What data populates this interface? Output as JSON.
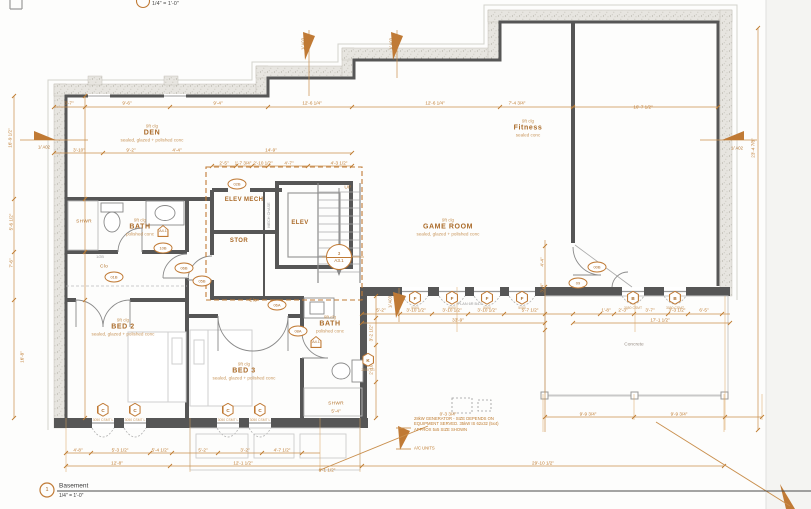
{
  "titles": {
    "top_scale": "1/4\" = 1'-0\"",
    "viewport_number": "1",
    "view_name": "Basement",
    "view_scale": "1/4\" = 1'-0\""
  },
  "colors": {
    "dim_orange": "#bf7b2f",
    "wall_gray": "#565656",
    "hatch_fill": "#e7e5e0"
  },
  "rooms": [
    {
      "name": "DEN",
      "clg": "9ft clg",
      "finish": "sealed, glazed + polished conc",
      "x": 152,
      "y": 133
    },
    {
      "name": "Fitness",
      "clg": "9ft clg",
      "finish": "sealed conc",
      "x": 528,
      "y": 128
    },
    {
      "name": "GAME ROOM",
      "clg": "9ft clg",
      "finish": "sealed, glazed + polished conc",
      "x": 448,
      "y": 227
    },
    {
      "name": "BATH",
      "clg": "9ft clg",
      "finish": "polished conc",
      "x": 140,
      "y": 227
    },
    {
      "name": "BED 2",
      "clg": "9ft clg",
      "finish": "sealed, glazed + polished conc",
      "x": 123,
      "y": 327
    },
    {
      "name": "BED 3",
      "clg": "9ft clg",
      "finish": "sealed, glazed + polished conc",
      "x": 244,
      "y": 371
    },
    {
      "name": "BATH",
      "clg": "9ft clg",
      "finish": "polished conc",
      "x": 330,
      "y": 324
    }
  ],
  "labels": [
    {
      "t": "ELEV MECH",
      "x": 244,
      "y": 200,
      "c": "rs"
    },
    {
      "t": "STOR",
      "x": 239,
      "y": 241,
      "c": "rs"
    },
    {
      "t": "ELEV",
      "x": 300,
      "y": 223,
      "c": "rs"
    },
    {
      "t": "Clo",
      "x": 104,
      "y": 267,
      "c": "lbl"
    },
    {
      "t": "Clo",
      "x": 253,
      "y": 301,
      "c": "lbl"
    },
    {
      "t": "SHWR",
      "x": 84,
      "y": 222,
      "c": "lbl"
    },
    {
      "t": "SHWR",
      "x": 336,
      "y": 404,
      "c": "lbl"
    },
    {
      "t": "UP",
      "x": 348,
      "y": 188,
      "c": "lbl"
    },
    {
      "t": "Concrete",
      "x": 634,
      "y": 345,
      "c": "lblg"
    },
    {
      "t": "MECH CHASE",
      "x": 269,
      "y": 215,
      "c": "tiny",
      "r": -90
    },
    {
      "t": "1/2B",
      "x": 100,
      "y": 257,
      "c": "tiny"
    },
    {
      "t": "PLAN 6R B4.0",
      "x": 470,
      "y": 304,
      "c": "tiny"
    }
  ],
  "dims": [
    {
      "t": "3'-7\"",
      "x": 69,
      "y": 103
    },
    {
      "t": "9'-6\"",
      "x": 127,
      "y": 103
    },
    {
      "t": "9'-4\"",
      "x": 218,
      "y": 103
    },
    {
      "t": "12'-6 1/4\"",
      "x": 312,
      "y": 103
    },
    {
      "t": "12'-6 1/4\"",
      "x": 435,
      "y": 103
    },
    {
      "t": "7'-4 3/4\"",
      "x": 517,
      "y": 103
    },
    {
      "t": "16'-7 1/2\"",
      "x": 643,
      "y": 107
    },
    {
      "t": "3'-10\"",
      "x": 79,
      "y": 150
    },
    {
      "t": "9'-2\"",
      "x": 131,
      "y": 150
    },
    {
      "t": "4'-4\"",
      "x": 177,
      "y": 150
    },
    {
      "t": "14'-9\"",
      "x": 271,
      "y": 150
    },
    {
      "t": "2'-5\"",
      "x": 224,
      "y": 163
    },
    {
      "t": "1'-7 3/4\"",
      "x": 243,
      "y": 163
    },
    {
      "t": "2'-10 1/2\"",
      "x": 263,
      "y": 163
    },
    {
      "t": "4'-7\"",
      "x": 289,
      "y": 163
    },
    {
      "t": "4'-3 1/2\"",
      "x": 339,
      "y": 163
    },
    {
      "t": "16'-9 1/2\"",
      "x": 10,
      "y": 138,
      "r": -90
    },
    {
      "t": "5'-6 1/2\"",
      "x": 11,
      "y": 222,
      "r": -90
    },
    {
      "t": "7'-6\"",
      "x": 11,
      "y": 263,
      "r": -90
    },
    {
      "t": "16'-8\"",
      "x": 22,
      "y": 357,
      "r": -90
    },
    {
      "t": "23'-4 7/8\"",
      "x": 753,
      "y": 148,
      "r": -90
    },
    {
      "t": "4'-4\"",
      "x": 542,
      "y": 262,
      "r": -90
    },
    {
      "t": "3'-4\"",
      "x": 542,
      "y": 288,
      "r": -90
    },
    {
      "t": "3'-2 1/2\"",
      "x": 371,
      "y": 333,
      "r": -90
    },
    {
      "t": "2'-10 1/2\"",
      "x": 371,
      "y": 365,
      "r": -90
    },
    {
      "t": "5'-2\"",
      "x": 381,
      "y": 310
    },
    {
      "t": "3'-10 1/2\"",
      "x": 416,
      "y": 310
    },
    {
      "t": "3'-10 1/2\"",
      "x": 452,
      "y": 310
    },
    {
      "t": "3'-10 1/2\"",
      "x": 487,
      "y": 310
    },
    {
      "t": "5'-7 1/2\"",
      "x": 530,
      "y": 310
    },
    {
      "t": "1'-8\"",
      "x": 606,
      "y": 310
    },
    {
      "t": "2'-3\"",
      "x": 623,
      "y": 310
    },
    {
      "t": "3'-7\"",
      "x": 650,
      "y": 310
    },
    {
      "t": "3'-3 1/2\"",
      "x": 677,
      "y": 310
    },
    {
      "t": "6'-5\"",
      "x": 704,
      "y": 310
    },
    {
      "t": "33'-9\"",
      "x": 458,
      "y": 320
    },
    {
      "t": "17'-1 1/2\"",
      "x": 660,
      "y": 320
    },
    {
      "t": "4'-8\"",
      "x": 78,
      "y": 450
    },
    {
      "t": "5'-3 1/2\"",
      "x": 120,
      "y": 450
    },
    {
      "t": "5'-4 1/2\"",
      "x": 160,
      "y": 450
    },
    {
      "t": "5'-2\"",
      "x": 203,
      "y": 450
    },
    {
      "t": "3'-2\"",
      "x": 245,
      "y": 450
    },
    {
      "t": "4'-7 1/2\"",
      "x": 282,
      "y": 450
    },
    {
      "t": "12'-8\"",
      "x": 117,
      "y": 463
    },
    {
      "t": "12'-1 1/2\"",
      "x": 243,
      "y": 463
    },
    {
      "t": "6'-1 1/2\"",
      "x": 327,
      "y": 470
    },
    {
      "t": "29'-10 1/2\"",
      "x": 543,
      "y": 463
    },
    {
      "t": "0'-3 3/4\"",
      "x": 448,
      "y": 414
    },
    {
      "t": "9'-9 3/4\"",
      "x": 588,
      "y": 414
    },
    {
      "t": "9'-9 3/4\"",
      "x": 679,
      "y": 414
    },
    {
      "t": "5'-4\"",
      "x": 336,
      "y": 411
    }
  ],
  "window_tags": [
    {
      "l": "C",
      "s": "3050 CSMT L",
      "x": 103,
      "y": 408
    },
    {
      "l": "C",
      "s": "3050 CSMT L",
      "x": 135,
      "y": 408
    },
    {
      "l": "C",
      "s": "3050 CSMT L",
      "x": 228,
      "y": 408
    },
    {
      "l": "C",
      "s": "3050 CSMT L",
      "x": 260,
      "y": 408
    },
    {
      "l": "F",
      "s": "5050",
      "x": 415,
      "y": 296
    },
    {
      "l": "F",
      "s": "5050",
      "x": 452,
      "y": 296
    },
    {
      "l": "F",
      "s": "5050",
      "x": 487,
      "y": 296
    },
    {
      "l": "F",
      "s": "5050",
      "x": 522,
      "y": 296
    },
    {
      "l": "B",
      "s": "3050 CSMT",
      "x": 633,
      "y": 296
    },
    {
      "l": "B",
      "s": "3050 CSMT",
      "x": 675,
      "y": 296
    },
    {
      "l": "K",
      "s": "2000 FG",
      "x": 368,
      "y": 358
    }
  ],
  "door_tags": [
    {
      "l": "10B",
      "x": 163,
      "y": 248
    },
    {
      "l": "01B",
      "x": 114,
      "y": 277
    },
    {
      "l": "06B",
      "x": 184,
      "y": 268
    },
    {
      "l": "05B",
      "x": 202,
      "y": 281
    },
    {
      "l": "02B",
      "x": 237,
      "y": 184
    },
    {
      "l": "06A",
      "x": 277,
      "y": 305
    },
    {
      "l": "08A",
      "x": 298,
      "y": 331
    },
    {
      "l": "00B",
      "x": 597,
      "y": 267
    },
    {
      "l": "09",
      "x": 578,
      "y": 283
    }
  ],
  "pent_tags": [
    {
      "l": "A4.1",
      "x": 163,
      "y": 231
    },
    {
      "l": "A4.1",
      "x": 316,
      "y": 342
    }
  ],
  "section_marker": {
    "top": "3",
    "bottom": "A3.1",
    "x": 339,
    "y": 257
  },
  "flags": [
    {
      "t": "1/ A02",
      "x": 44,
      "y": 147
    },
    {
      "t": "1/ A02",
      "x": 737,
      "y": 148
    },
    {
      "t": "1/ A03",
      "x": 303,
      "y": 44,
      "r": -90
    },
    {
      "t": "1/ A03",
      "x": 391,
      "y": 44,
      "r": -90
    },
    {
      "t": "1/ A03",
      "x": 390,
      "y": 302,
      "r": -90
    }
  ],
  "notes": [
    {
      "lines": [
        "28kW GENERATOR - SIZE DEPENDS ON",
        "EQUIPMENT SERVED. 35kW IS 62x32 (5x4)",
        "APPROX 5x5 SIZE SHOWN"
      ],
      "x": 414,
      "y": 424
    },
    {
      "lines": [
        "A/C UNITS"
      ],
      "x": 414,
      "y": 448
    }
  ]
}
